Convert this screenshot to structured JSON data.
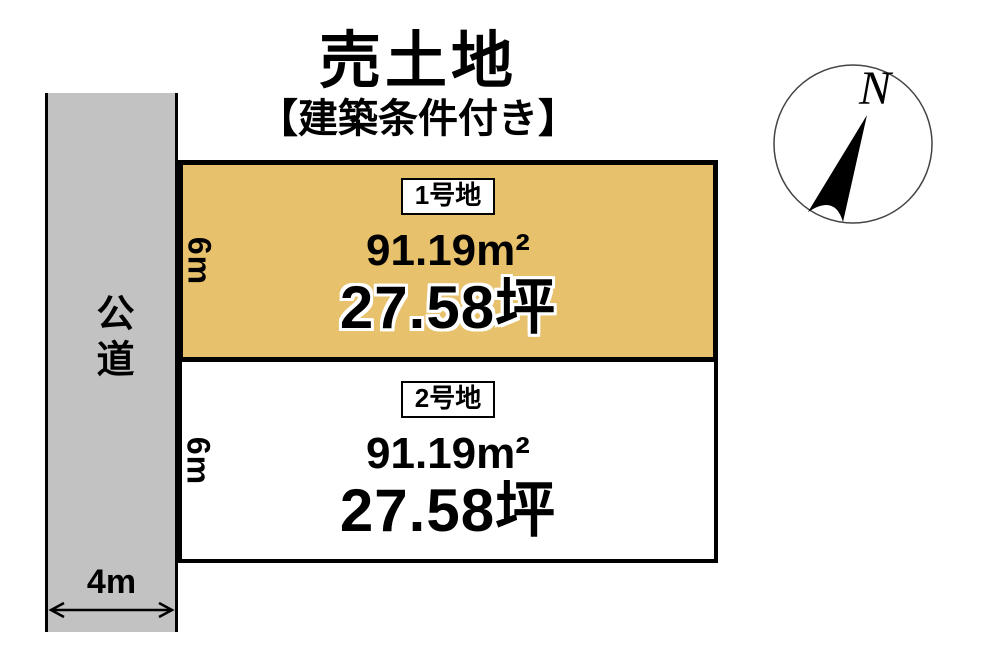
{
  "title": "売土地",
  "subtitle": "【建築条件付き】",
  "compass": {
    "north_label": "N"
  },
  "road": {
    "name": "公道",
    "width_label": "4m"
  },
  "plots": [
    {
      "id": "1号地",
      "area_sqm": "91.19m²",
      "area_tsubo": "27.58坪",
      "frontage_label": "6m",
      "fill": "#e7c16b"
    },
    {
      "id": "2号地",
      "area_sqm": "91.19m²",
      "area_tsubo": "27.58坪",
      "frontage_label": "6m",
      "fill": "#ffffff"
    }
  ],
  "colors": {
    "road_fill": "#c2c2c2",
    "highlight_fill": "#e7c16b",
    "outline": "#000000",
    "background": "#ffffff"
  }
}
